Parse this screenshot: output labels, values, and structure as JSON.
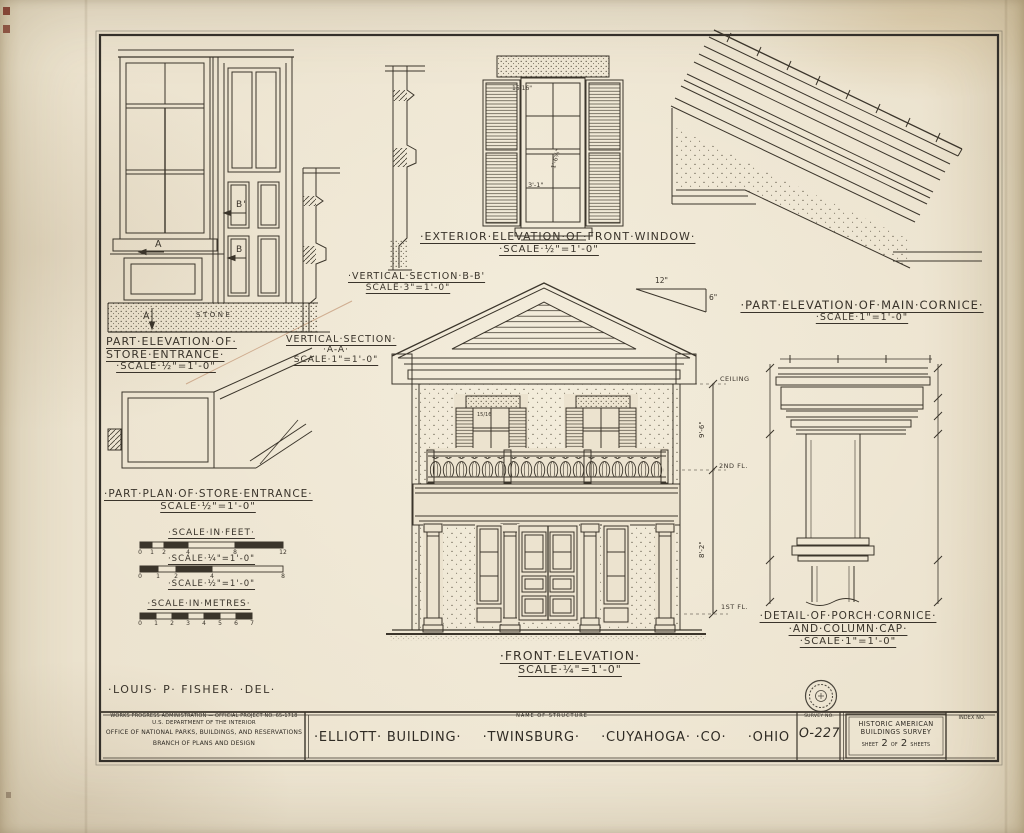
{
  "sheet": {
    "colors": {
      "paper": "#ece3cf",
      "ink": "#3a342b",
      "stain": "#a8643a",
      "mark_red": "#7c392a"
    },
    "delineator": "·LOUIS· P· FISHER· ·DEL·"
  },
  "drawings": {
    "store_entrance_elevation": {
      "title_line1": "PART·ELEVATION·OF·",
      "title_line2": "STORE·ENTRANCE·",
      "scale": "·SCALE·½\"=1'-0\"",
      "marks": {
        "a_top": "A",
        "b_top": "B'",
        "b_bottom": "B",
        "a_bottom": "A",
        "stone": "STONE"
      }
    },
    "vertical_section_bb": {
      "title": "·VERTICAL·SECTION·B-B'",
      "scale": "SCALE·3\"=1'-0\""
    },
    "vertical_section_aa": {
      "title": "VERTICAL·SECTION·",
      "title_line2": "·A-A·",
      "scale": "SCALE·1\"=1'-0\""
    },
    "front_window_elevation": {
      "title": "·EXTERIOR·ELEVATION·OF·FRONT·WINDOW·",
      "scale": "·SCALE·½\"=1'-0\"",
      "dims": {
        "pane": "15/16\"",
        "height": "1'-6⅝\"",
        "width": "3'-1\""
      }
    },
    "main_cornice_elevation": {
      "title": "·PART·ELEVATION·OF·MAIN·CORNICE·",
      "scale": "·SCALE·1\"=1'-0\""
    },
    "front_elevation": {
      "title": "·FRONT·ELEVATION·",
      "scale": "SCALE·¼\"=1'-0\"",
      "pitch_run": "12\"",
      "pitch_rise": "6\"",
      "window_dim": "15/16",
      "levels": {
        "ceiling": "CEILING",
        "story2_height": "9'-6\"",
        "second_floor": "2ND FL.",
        "story1_height": "8'-2\"",
        "first_floor": "1ST FL."
      }
    },
    "store_entrance_plan": {
      "title": "·PART·PLAN·OF·STORE·ENTRANCE·",
      "scale": "SCALE·½\"=1'-0\""
    },
    "porch_detail": {
      "title_line1": "·DETAIL·OF·PORCH·CORNICE·",
      "title_line2": "·AND·COLUMN·CAP·",
      "scale": "·SCALE·1\"=1'-0\""
    }
  },
  "scale_bars": {
    "feet_title": "·SCALE·IN·FEET·",
    "quarter_caption": "·SCALE·¼\"=1'-0\"",
    "half_caption": "·SCALE·½\"=1'-0\"",
    "metres_title": "·SCALE·IN·METRES·",
    "feet_quarter_ticks": [
      "0",
      "1",
      "2",
      "4",
      "8",
      "12"
    ],
    "feet_half_ticks": [
      "0",
      "1",
      "2",
      "4",
      "8"
    ],
    "metre_ticks": [
      "0",
      "1",
      "2",
      "3",
      "4",
      "5",
      "6",
      "7"
    ]
  },
  "title_block": {
    "agency_line1": "WORKS PROGRESS ADMINISTRATION — OFFICIAL PROJECT NO. 65-1718",
    "agency_line2": "U.S. DEPARTMENT OF THE INTERIOR",
    "agency_line3": "OFFICE OF NATIONAL PARKS, BUILDINGS, AND RESERVATIONS",
    "agency_line4": "BRANCH OF PLANS AND DESIGN",
    "name_of_structure_label": "NAME OF STRUCTURE",
    "structure_name_parts": [
      "·ELLIOTT· BUILDING·",
      "·TWINSBURG·",
      "·CUYAHOGA· ·CO·",
      "·OHIO"
    ],
    "survey_label": "SURVEY NO.",
    "survey_number": "O-227",
    "habs_line1": "HISTORIC AMERICAN",
    "habs_line2": "BUILDINGS SURVEY",
    "sheet_word": "SHEET",
    "sheet_number": "2",
    "of_word": "OF",
    "sheet_total": "2",
    "sheets_word": "SHEETS",
    "index_label": "INDEX NO."
  }
}
